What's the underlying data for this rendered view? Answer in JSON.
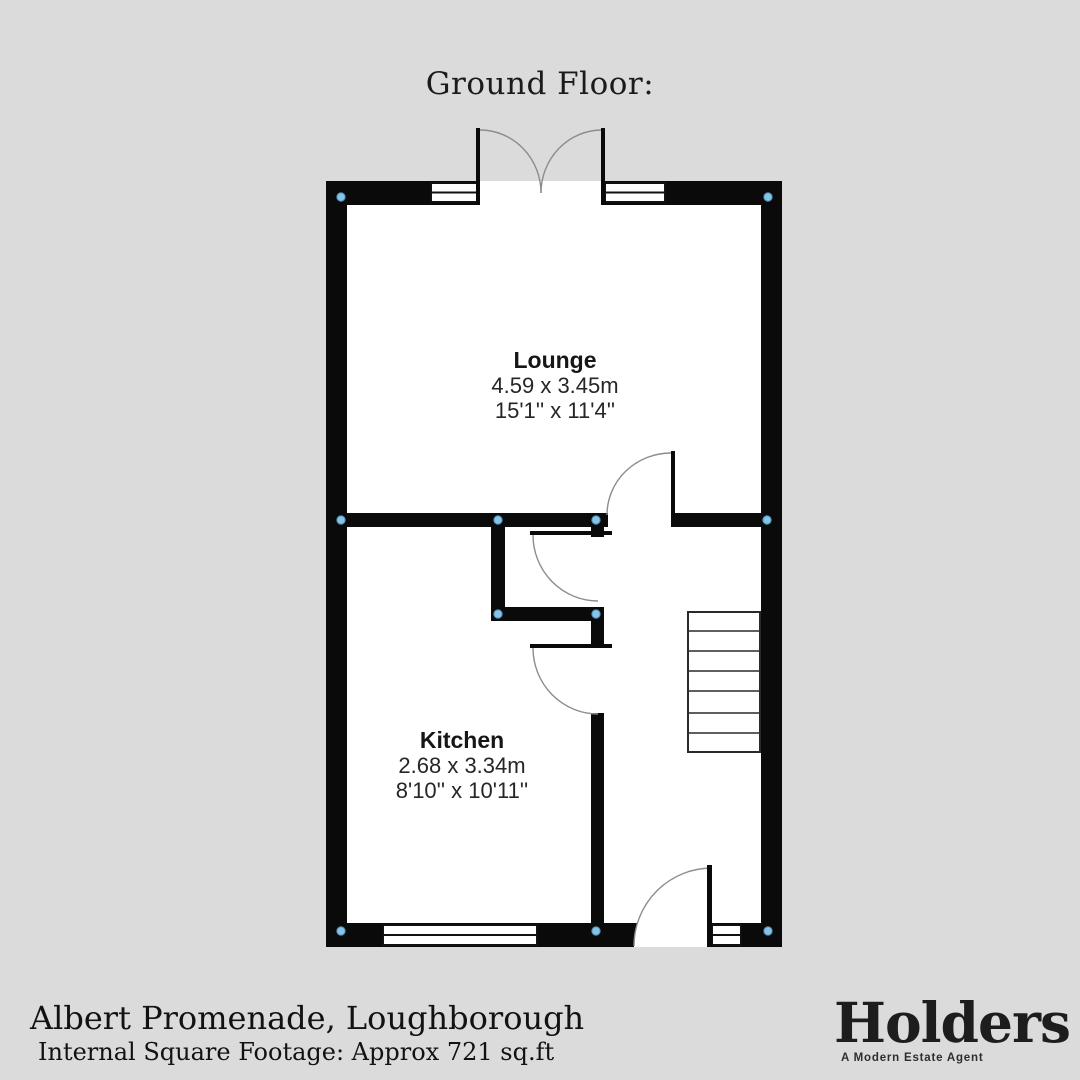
{
  "title": "Ground Floor:",
  "rooms": [
    {
      "name": "Lounge",
      "metric": "4.59 x 3.45m",
      "imperial": "15'1'' x 11'4''"
    },
    {
      "name": "Kitchen",
      "metric": "2.68 x 3.34m",
      "imperial": "8'10'' x 10'11''"
    }
  ],
  "footer": {
    "address": "Albert Promenade, Loughborough",
    "footage": "Internal Square Footage: Approx 721 sq.ft"
  },
  "brand": {
    "name": "Holders",
    "tagline": "A Modern Estate Agent"
  },
  "icons": {
    "corner_marker": "light-blue-dot"
  },
  "colors": {
    "background": "#dbdbdb",
    "floor": "#ffffff",
    "wall": "#0a0a0a",
    "door_arc": "#8d8d8d",
    "marker_fill": "#85c3e8",
    "marker_stroke": "#4d88ab",
    "text": "#1b1b1b",
    "brand": "#1d1d1d"
  }
}
